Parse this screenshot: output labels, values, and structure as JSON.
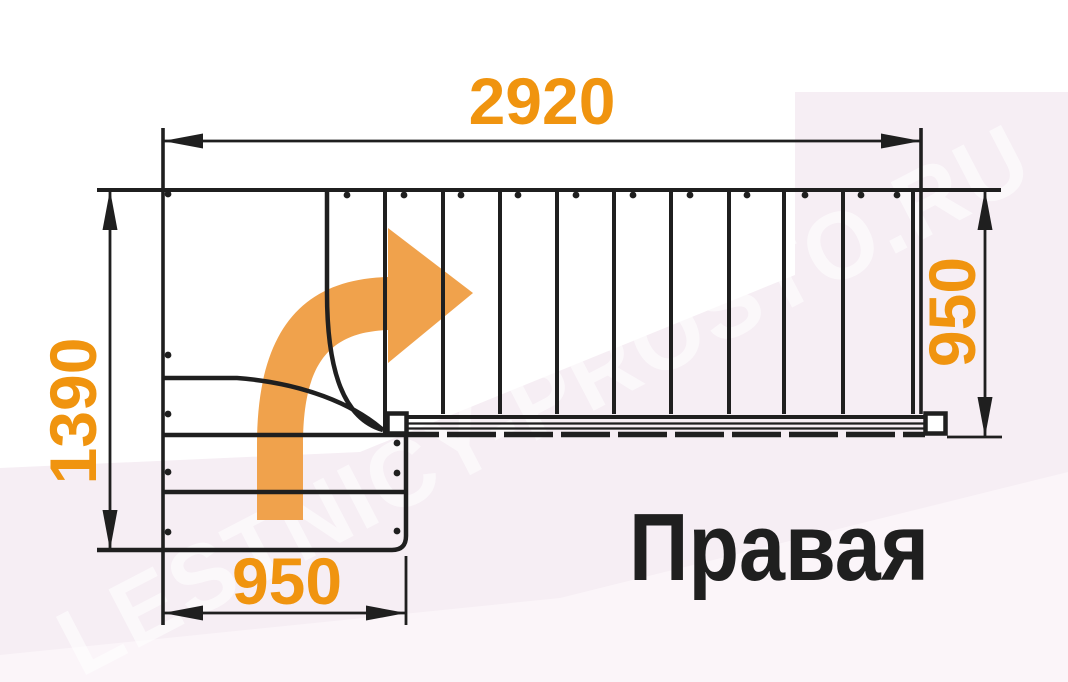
{
  "diagram": {
    "turn_label": "Правая",
    "watermark": "LESTNICY-PROSTO.RU",
    "dimensions": {
      "total_length_mm": "2920",
      "total_depth_mm": "1390",
      "upper_flight_width_mm": "950",
      "lower_flight_width_mm": "950"
    },
    "stairs": {
      "turn_direction": "right",
      "upper_straight_treads": 10,
      "winder_treads": 3,
      "lower_straight_treads": 2
    },
    "colors": {
      "line": "#1f1f1f",
      "dimension_text": "#F0940F",
      "title_text": "#1f1f1f",
      "arrow": "#F0A24C",
      "watermark_pink": "#F6EEF4",
      "watermark_pink_light": "#FBF5F9",
      "canvas": "#FFFFFF"
    }
  }
}
